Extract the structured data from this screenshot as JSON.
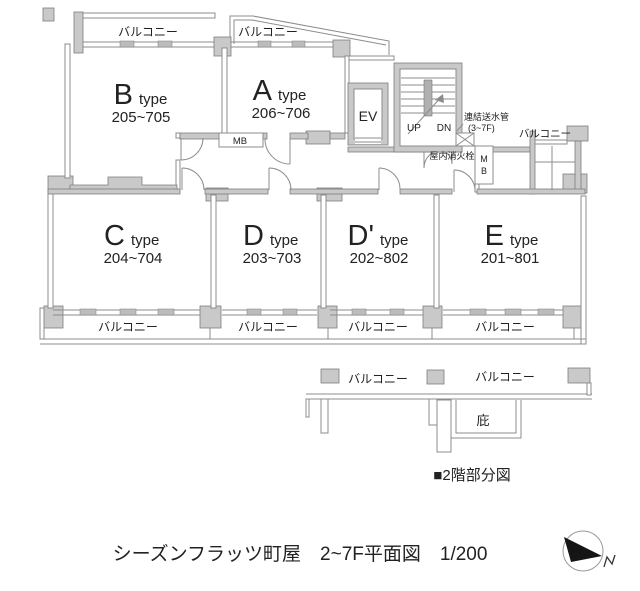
{
  "main_plan": {
    "balcony_label": "バルコニー",
    "units": [
      {
        "letter": "B",
        "suffix": "type",
        "range": "205~705"
      },
      {
        "letter": "A",
        "suffix": "type",
        "range": "206~706"
      },
      {
        "letter": "C",
        "suffix": "type",
        "range": "204~704"
      },
      {
        "letter": "D",
        "suffix": "type",
        "range": "203~703"
      },
      {
        "letter": "D'",
        "suffix": "type",
        "range": "202~802"
      },
      {
        "letter": "E",
        "suffix": "type",
        "range": "201~801"
      }
    ],
    "elevator_label": "EV",
    "stairs_up_label": "UP",
    "stairs_down_label": "DN",
    "standpipe_label": "連結送水管",
    "standpipe_floors": "(3~7F)",
    "hydrant_label": "屋内消火栓",
    "meter_box_label": "MB",
    "meter_box_vertical": {
      "m": "M",
      "b": "B"
    }
  },
  "partial_plan": {
    "balcony_label": "バルコニー",
    "canopy_label": "庇",
    "caption": "■2階部分図"
  },
  "footer_caption": "シーズンフラッツ町屋　2~7F平面図　1/200",
  "colors": {
    "wall_fill": "#c9c9c9",
    "wall_stroke": "#7e7e7e",
    "line": "#8c8c8c",
    "text": "#222222"
  }
}
